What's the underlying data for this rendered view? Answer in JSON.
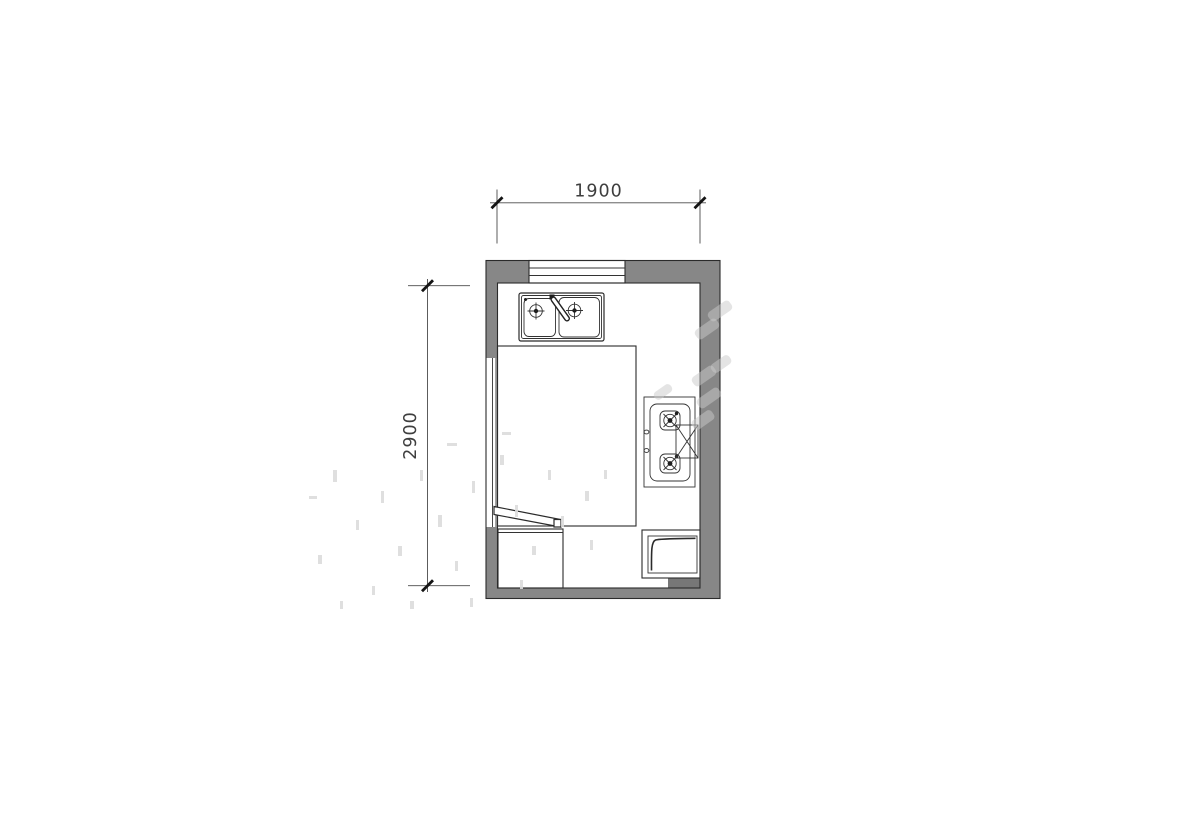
{
  "dimensions": {
    "top": {
      "label": "1900"
    },
    "left": {
      "label": "2900"
    }
  },
  "fixtures": {
    "sink": "double-bowl-sink-with-faucet",
    "cooktop": "two-burner-gas-cooktop",
    "hood": "range-hood",
    "window": "window",
    "opening": "door-opening-with-leaf",
    "cabinet": "base-cabinet",
    "appliance": "bottom-right-appliance",
    "duct": "wall-duct"
  },
  "colors": {
    "background": "#ffffff",
    "wall_fill": "#878787",
    "duct_fill": "#777777",
    "line": "#2b2b2b",
    "dimension_line": "#4a4a4a",
    "dimension_text": "#3e3e3e",
    "watermark_bar": "#c9c9c9",
    "watermark_dash": "#dcdcdc"
  },
  "watermark": {
    "bar_color": "#c9c9c9",
    "bar_opacity": 0.5,
    "dash_color": "#dcdcdc",
    "dash_opacity": 0.9,
    "bars": [
      {
        "cx": 720,
        "cy": 311,
        "w": 26,
        "h": 11,
        "r": -35
      },
      {
        "cx": 707,
        "cy": 329,
        "w": 26,
        "h": 11,
        "r": -35
      },
      {
        "cx": 721,
        "cy": 364,
        "w": 22,
        "h": 10,
        "r": -35
      },
      {
        "cx": 704,
        "cy": 376,
        "w": 26,
        "h": 11,
        "r": -35
      },
      {
        "cx": 709,
        "cy": 398,
        "w": 26,
        "h": 11,
        "r": -35
      },
      {
        "cx": 703,
        "cy": 420,
        "w": 24,
        "h": 11,
        "r": -35
      },
      {
        "cx": 663,
        "cy": 392,
        "w": 20,
        "h": 9,
        "r": -35
      }
    ],
    "dashes": [
      {
        "x": 333,
        "y": 470,
        "w": 4,
        "h": 12
      },
      {
        "x": 356,
        "y": 520,
        "w": 3,
        "h": 10
      },
      {
        "x": 318,
        "y": 555,
        "w": 4,
        "h": 9
      },
      {
        "x": 381,
        "y": 491,
        "w": 3,
        "h": 12
      },
      {
        "x": 398,
        "y": 546,
        "w": 4,
        "h": 10
      },
      {
        "x": 372,
        "y": 586,
        "w": 3,
        "h": 9
      },
      {
        "x": 420,
        "y": 470,
        "w": 3,
        "h": 11
      },
      {
        "x": 438,
        "y": 515,
        "w": 4,
        "h": 12
      },
      {
        "x": 455,
        "y": 561,
        "w": 3,
        "h": 10
      },
      {
        "x": 472,
        "y": 481,
        "w": 3,
        "h": 12
      },
      {
        "x": 500,
        "y": 455,
        "w": 4,
        "h": 10
      },
      {
        "x": 515,
        "y": 505,
        "w": 3,
        "h": 12
      },
      {
        "x": 532,
        "y": 546,
        "w": 4,
        "h": 9
      },
      {
        "x": 548,
        "y": 470,
        "w": 3,
        "h": 10
      },
      {
        "x": 561,
        "y": 516,
        "w": 3,
        "h": 11
      },
      {
        "x": 585,
        "y": 491,
        "w": 4,
        "h": 10
      },
      {
        "x": 340,
        "y": 601,
        "w": 3,
        "h": 8
      },
      {
        "x": 410,
        "y": 601,
        "w": 4,
        "h": 8
      },
      {
        "x": 470,
        "y": 598,
        "w": 3,
        "h": 9
      },
      {
        "x": 520,
        "y": 580,
        "w": 3,
        "h": 9
      },
      {
        "x": 590,
        "y": 540,
        "w": 3,
        "h": 10
      },
      {
        "x": 604,
        "y": 470,
        "w": 3,
        "h": 9
      },
      {
        "x": 447,
        "y": 443,
        "w": 10,
        "h": 3
      },
      {
        "x": 502,
        "y": 432,
        "w": 9,
        "h": 3
      },
      {
        "x": 309,
        "y": 496,
        "w": 8,
        "h": 3
      }
    ]
  }
}
